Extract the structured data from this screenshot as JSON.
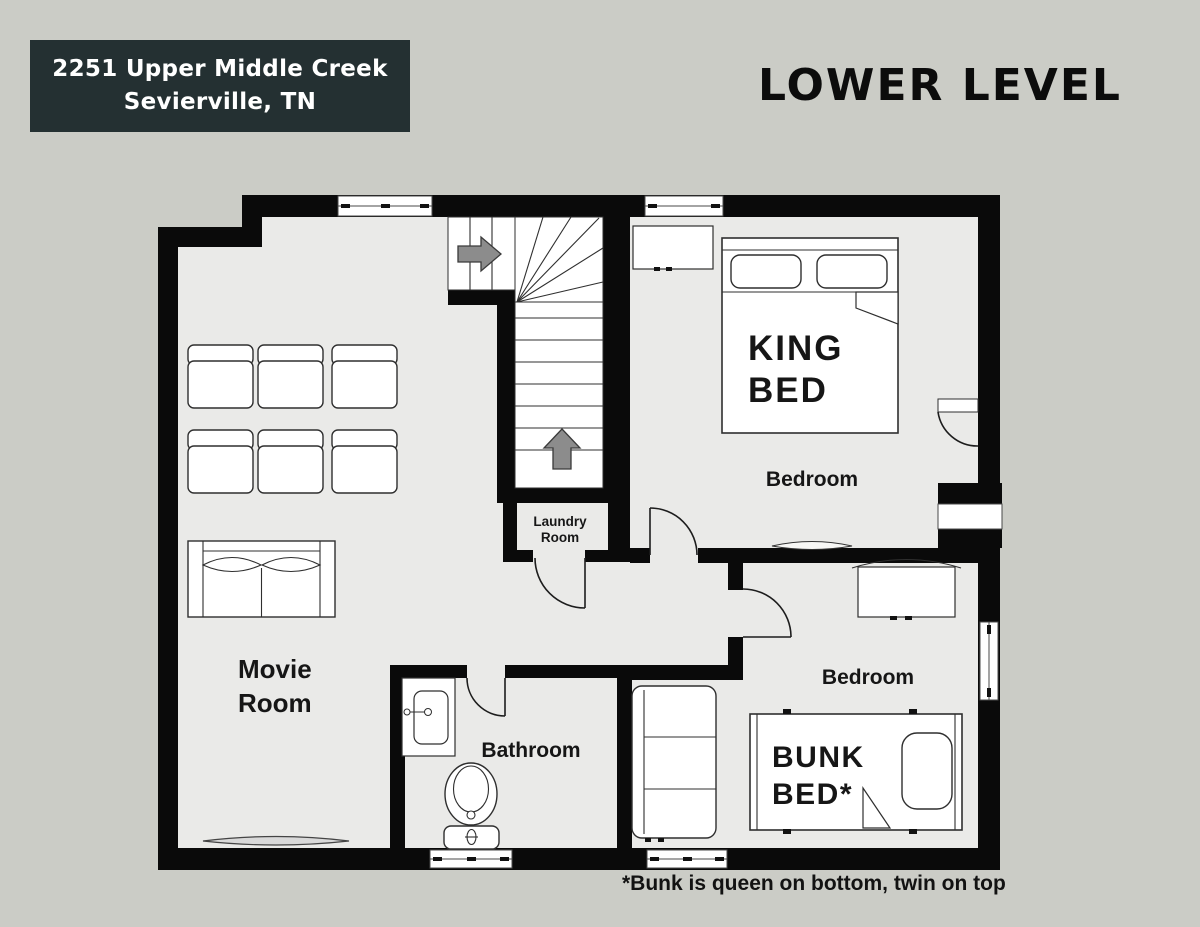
{
  "colors": {
    "page-bg": "#cbccc6",
    "address-bg": "#243032",
    "wall": "#0a0a0a",
    "floor": "#eaeae8",
    "furniture": "#ffffff",
    "arrow": "#8c8c8c"
  },
  "header": {
    "address_line1": "2251 Upper Middle Creek",
    "address_line2": "Sevierville, TN",
    "title": "LOWER LEVEL"
  },
  "floorplan": {
    "movie_room": {
      "label_line1": "Movie",
      "label_line2": "Room"
    },
    "laundry_room": {
      "label_line1": "Laundry",
      "label_line2": "Room"
    },
    "bathroom": {
      "label": "Bathroom"
    },
    "king_bedroom": {
      "label": "Bedroom",
      "bed_line1": "KING",
      "bed_line2": "BED"
    },
    "bunk_bedroom": {
      "label": "Bedroom",
      "bed_line1": "BUNK",
      "bed_line2": "BED*"
    }
  },
  "footnote": "*Bunk is queen on bottom, twin on top"
}
